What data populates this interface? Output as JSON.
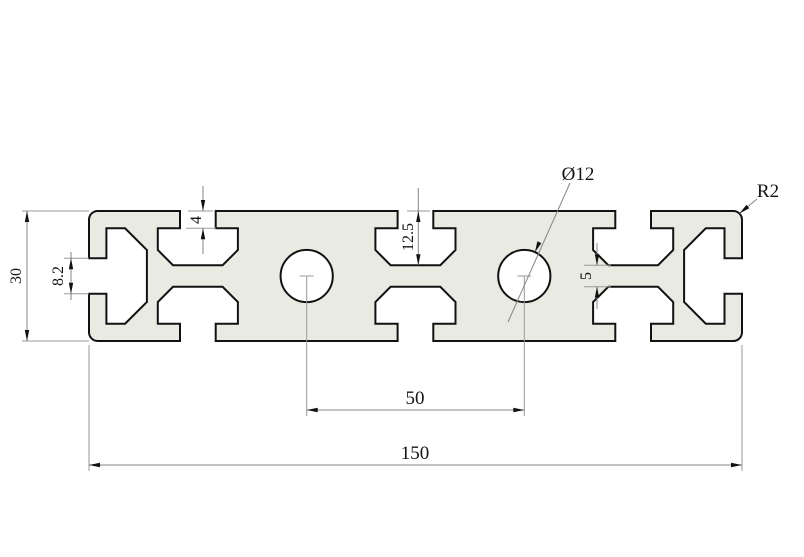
{
  "drawing": {
    "type": "technical-drawing",
    "subject": "aluminium-extrusion-profile-cross-section",
    "colors": {
      "background": "#ffffff",
      "profile_fill": "#e9eae2",
      "outline": "#121212",
      "dimension_lines": "#858585",
      "text": "#141414"
    }
  },
  "profile": {
    "width_mm": 150,
    "height_mm": 30,
    "slot_centers_mm": [
      25,
      75,
      125
    ],
    "slot_opening_mm": 8.2,
    "slot_neck_depth_mm": 4,
    "slot_depth_mm": 12.5,
    "center_web_mm": 5,
    "hole_diameter_mm": 12,
    "hole_spacing_mm": 50,
    "corner_radius_mm": 2,
    "hole_count": 2
  },
  "dimensions": {
    "total_width": "150",
    "hole_spacing": "50",
    "height": "30",
    "slot_opening": "8.2",
    "neck_depth": "4",
    "slot_depth": "12.5",
    "web_thickness": "5",
    "hole_diameter": "Ø12",
    "corner_radius": "R2"
  }
}
